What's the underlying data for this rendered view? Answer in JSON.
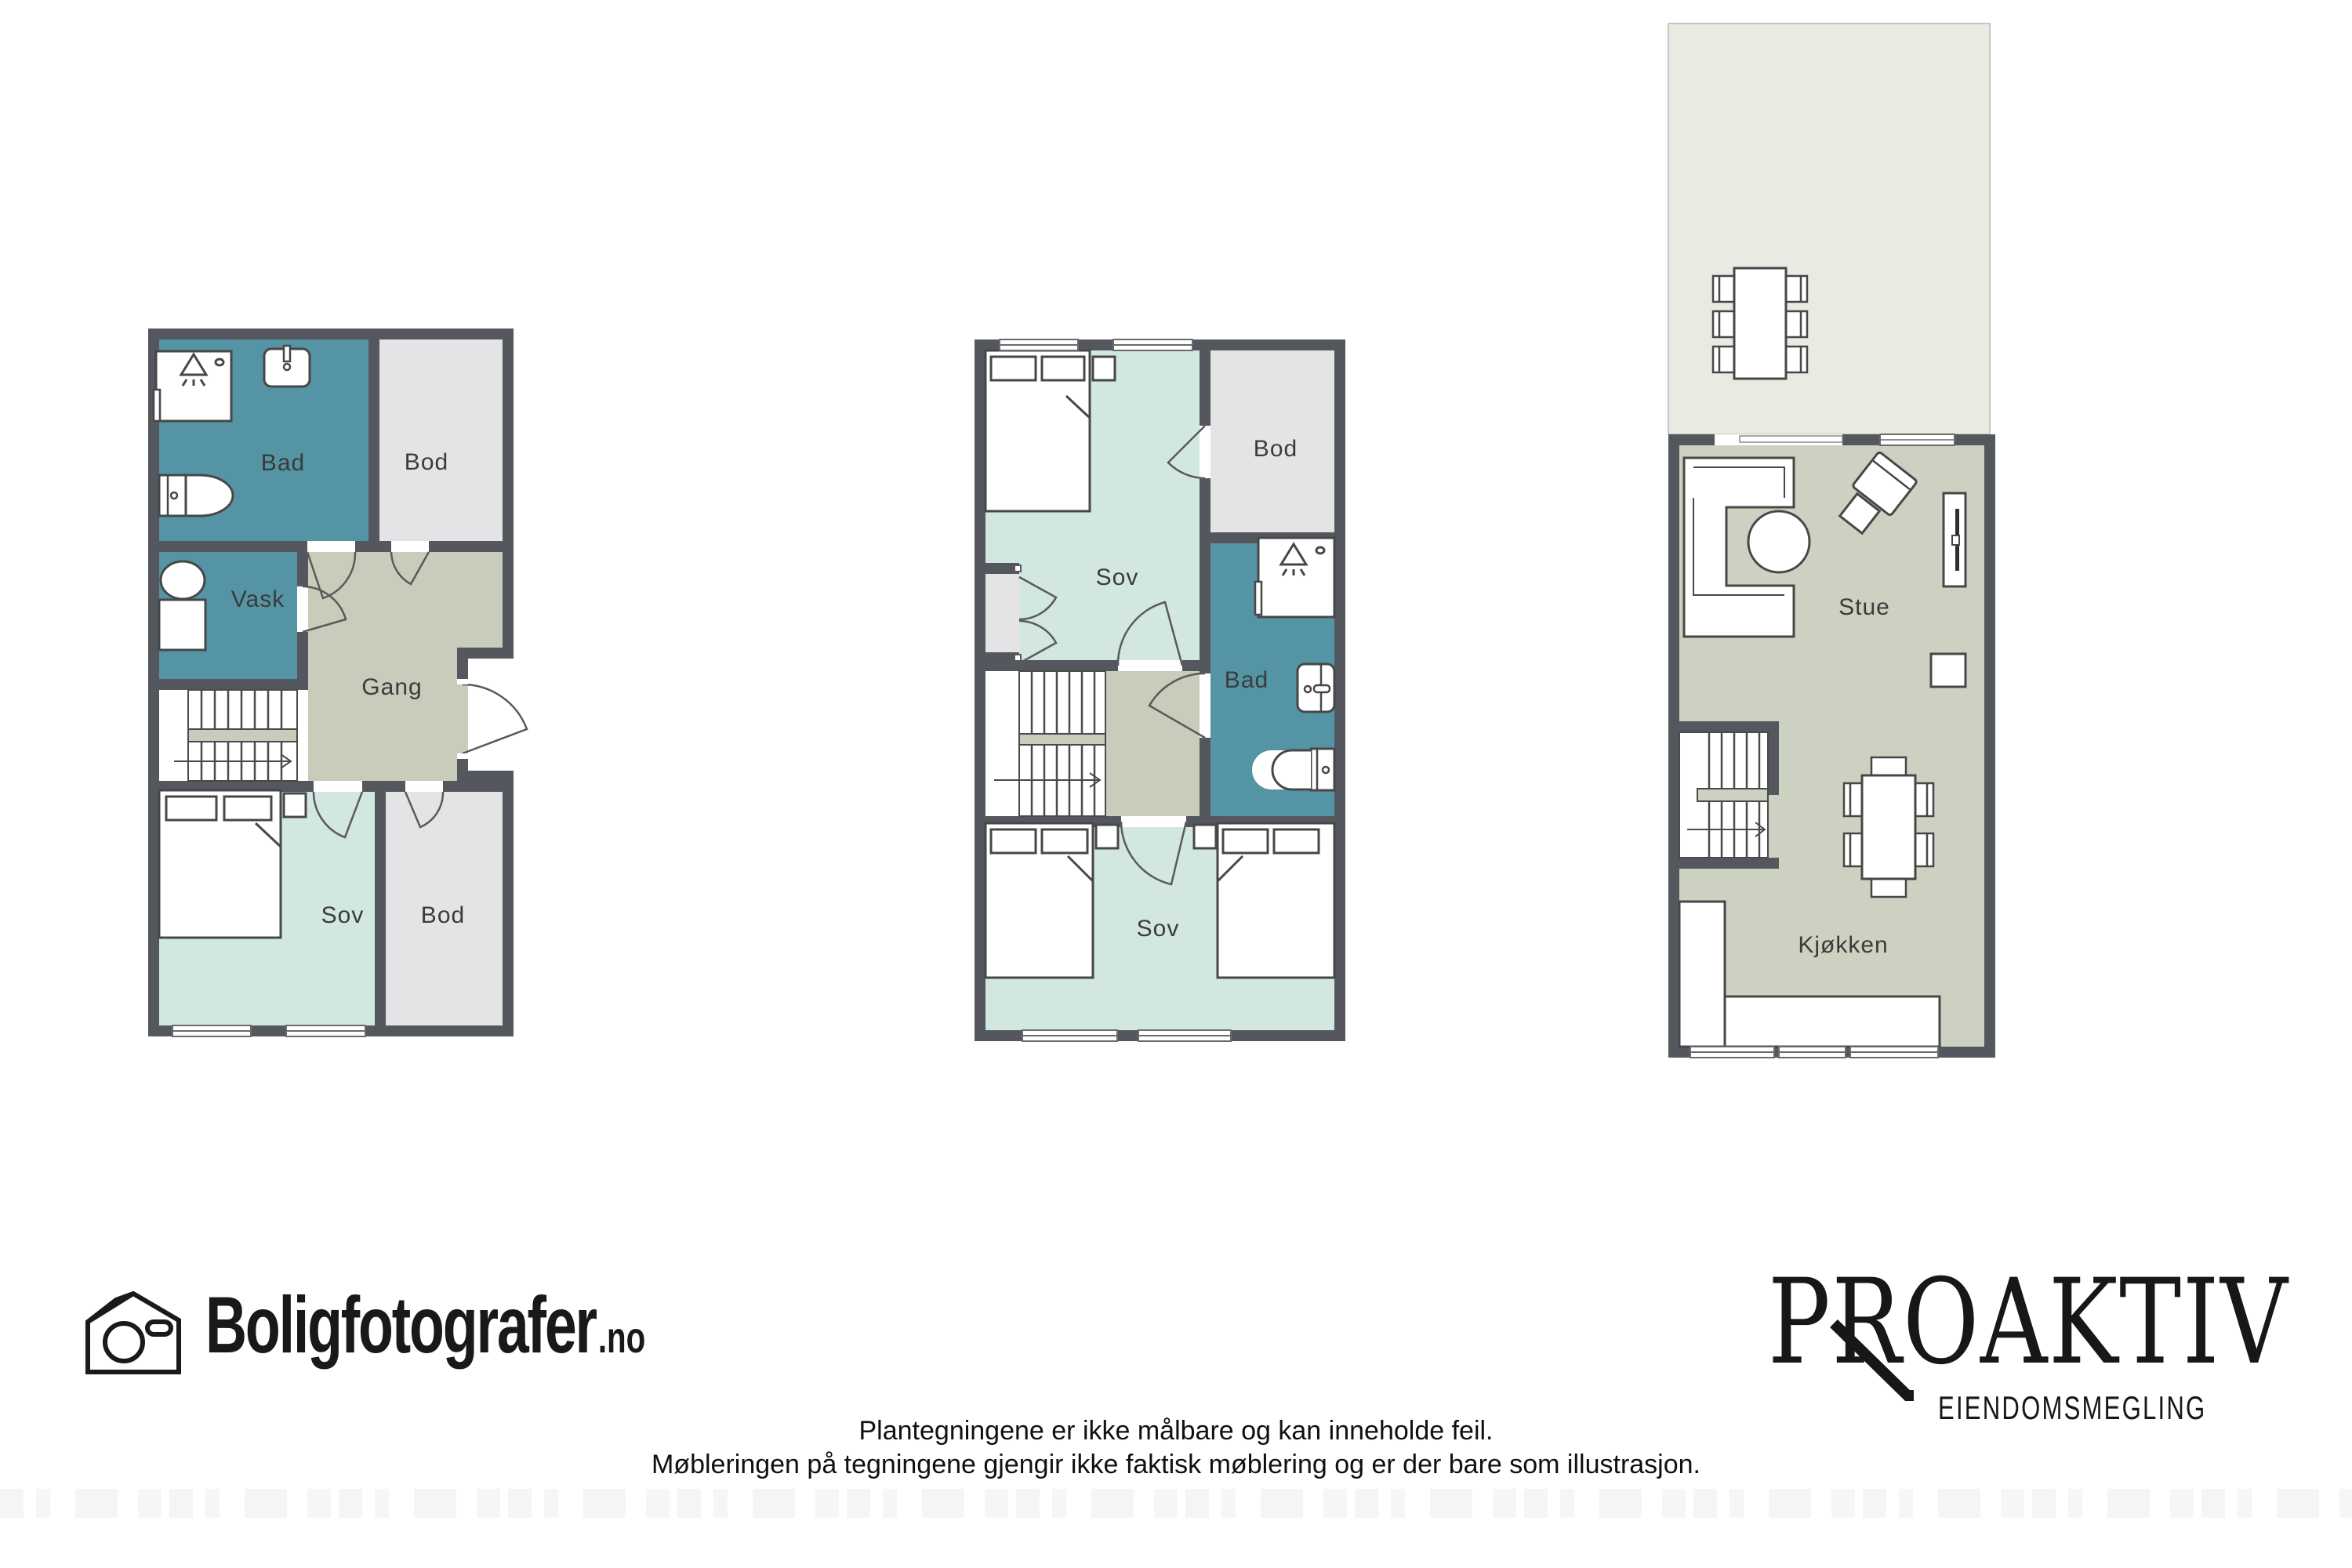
{
  "branding": {
    "boligfotografer": {
      "name": "Boligfotografer",
      "tld": ".no",
      "icon": "house-camera-icon"
    },
    "proaktiv": {
      "name": "PROAKTIV",
      "subtitle": "EIENDOMSMEGLING"
    }
  },
  "disclaimer": {
    "line1": "Plantegningene er ikke målbare og kan inneholde feil.",
    "line2": "Møbleringen på tegningene gjengir ikke faktisk møblering og er der bare som illustrasjon."
  },
  "colors": {
    "wall": "#54575e",
    "wet_room": "#5494a4",
    "bedroom": "#d2e7df",
    "hall": "#c9ccba",
    "storage": "#e4e4e6",
    "living": "#cdd1c1",
    "terrace": "#e9eae2",
    "furniture_outline": "#474747"
  },
  "plans": [
    {
      "id": "underetasje",
      "rooms": [
        {
          "label": "Bad"
        },
        {
          "label": "Bod"
        },
        {
          "label": "Vask"
        },
        {
          "label": "Gang"
        },
        {
          "label": "Sov"
        },
        {
          "label": "Bod"
        }
      ]
    },
    {
      "id": "etasje",
      "rooms": [
        {
          "label": "Sov"
        },
        {
          "label": "Bod"
        },
        {
          "label": "Bad"
        },
        {
          "label": "Sov"
        }
      ]
    },
    {
      "id": "hovedetasje",
      "rooms": [
        {
          "label": "Stue"
        },
        {
          "label": "Kjøkken"
        }
      ]
    }
  ]
}
